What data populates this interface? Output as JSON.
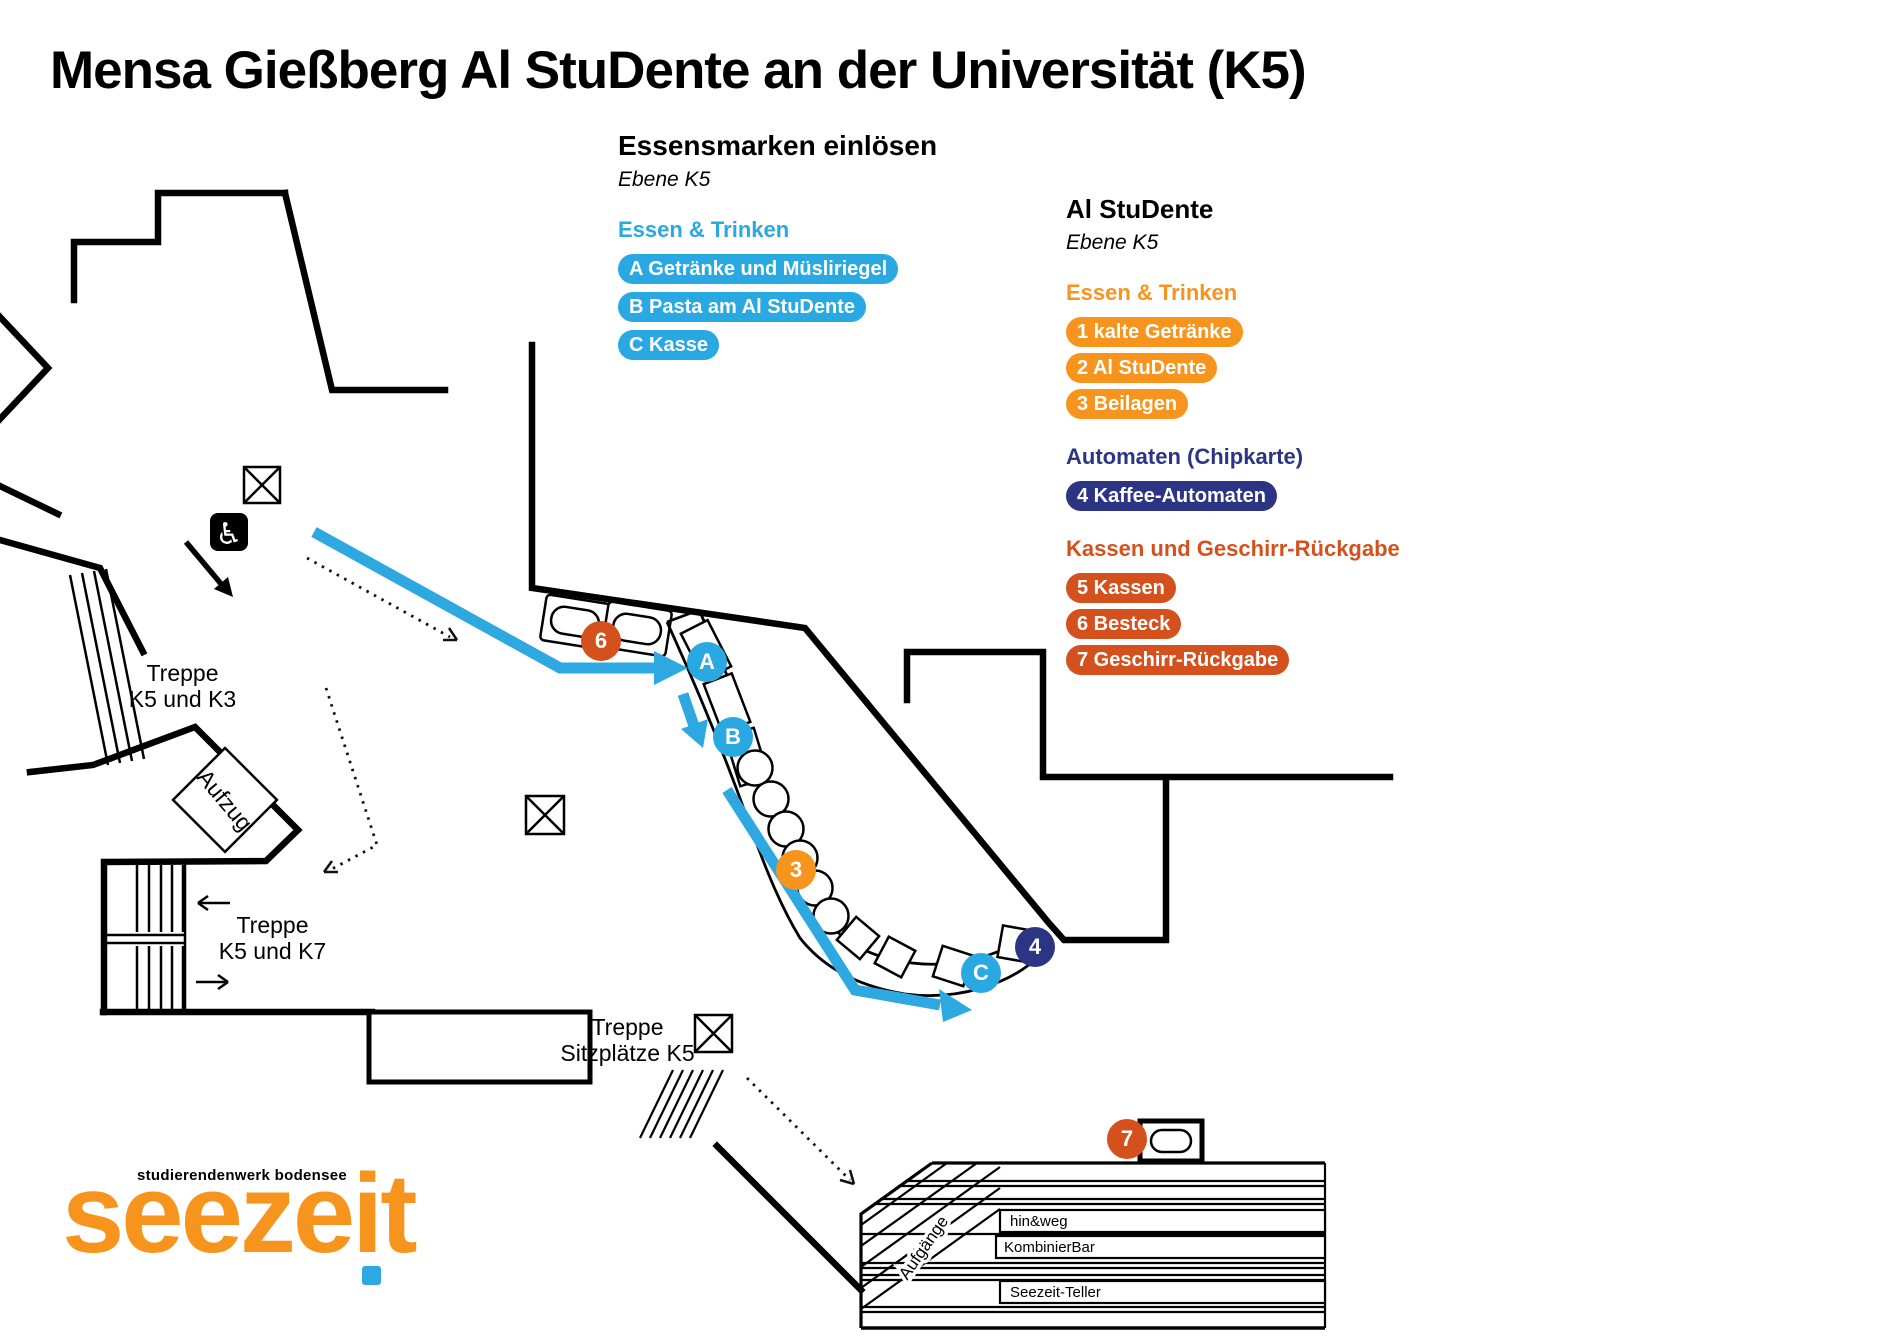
{
  "title": "Mensa Gießberg Al StuDente an der Universität (K5)",
  "legend_left": {
    "heading": "Essensmarken einlösen",
    "level": "Ebene K5",
    "sections": [
      {
        "title": "Essen & Trinken",
        "color": "#29A8E1",
        "items": [
          "A Getränke und Müsliriegel",
          "B Pasta am Al StuDente",
          "C Kasse"
        ]
      }
    ]
  },
  "legend_right": {
    "heading": "Al StuDente",
    "level": "Ebene K5",
    "sections": [
      {
        "title": "Essen & Trinken",
        "color": "#F7941D",
        "items": [
          "1 kalte Getränke",
          "2 Al StuDente",
          "3 Beilagen"
        ]
      },
      {
        "title": "Automaten (Chipkarte)",
        "color": "#2B3583",
        "items": [
          "4 Kaffee-Automaten"
        ]
      },
      {
        "title": "Kassen und Geschirr-Rückgabe",
        "color": "#D4511E",
        "items": [
          "5 Kassen",
          "6 Besteck",
          "7 Geschirr-Rückgabe"
        ]
      }
    ]
  },
  "map_labels": {
    "stairs_k3_line1": "Treppe",
    "stairs_k3_line2": "K5 und K3",
    "stairs_k7_line1": "Treppe",
    "stairs_k7_line2": "K5 und K7",
    "elevator": "Aufzug",
    "stairs_seats_line1": "Treppe",
    "stairs_seats_line2": "Sitzplätze K5",
    "ramp": "Aufgänge",
    "counters": [
      "hin&weg",
      "KombinierBar",
      "Seezeit-Teller"
    ]
  },
  "markers": [
    {
      "label": "6",
      "x": 601,
      "y": 641,
      "color": "#D4511E"
    },
    {
      "label": "A",
      "x": 707,
      "y": 662,
      "color": "#29A8E1"
    },
    {
      "label": "B",
      "x": 733,
      "y": 737,
      "color": "#29A8E1"
    },
    {
      "label": "3",
      "x": 796,
      "y": 870,
      "color": "#F7941D"
    },
    {
      "label": "C",
      "x": 981,
      "y": 973,
      "color": "#29A8E1"
    },
    {
      "label": "4",
      "x": 1035,
      "y": 947,
      "color": "#2B3583"
    },
    {
      "label": "7",
      "x": 1127,
      "y": 1139,
      "color": "#D4511E"
    }
  ],
  "logo": {
    "tagline": "studierendenwerk bodensee",
    "wordmark": "seezeit",
    "wordmark_color": "#F7941D",
    "dot_color": "#2EA8E0"
  }
}
